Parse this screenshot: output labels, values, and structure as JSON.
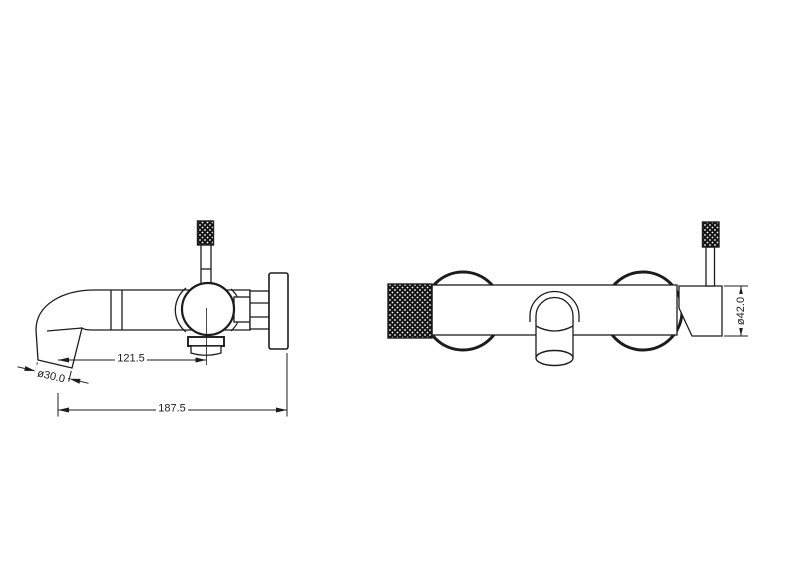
{
  "page": {
    "background": "#ffffff",
    "line_color": "#1c1c1c"
  },
  "drawing": {
    "dims": {
      "outlet_to_valve": "121.5",
      "overall_length": "187.5",
      "outlet_diameter": "ø30.0",
      "body_diameter": "ø42.0"
    }
  }
}
